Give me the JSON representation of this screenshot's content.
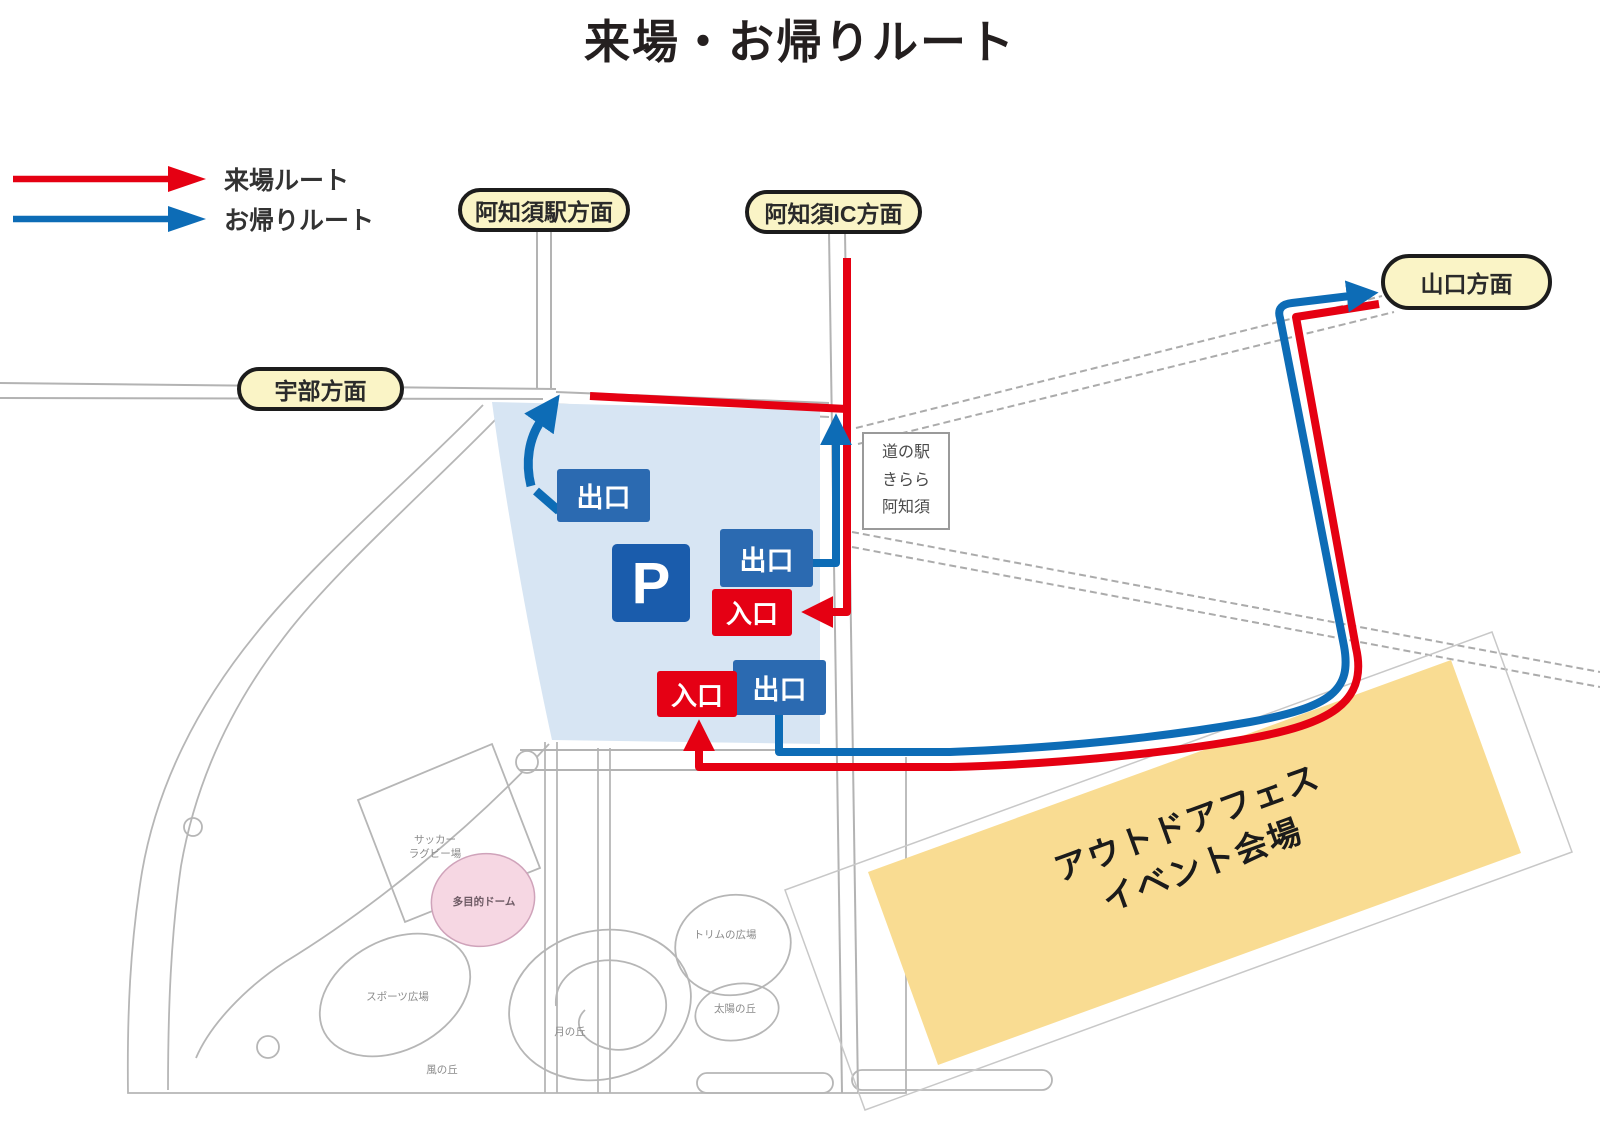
{
  "title": "来場・お帰りルート",
  "legend": {
    "arrival": {
      "label": "来場ルート",
      "color": "#e50012"
    },
    "return": {
      "label": "お帰りルート",
      "color": "#0d6cb6"
    }
  },
  "directions": {
    "station": "阿知須駅方面",
    "ic": "阿知須IC方面",
    "yamaguchi": "山口方面",
    "ube": "宇部方面"
  },
  "parking": {
    "symbol": "P",
    "exit_label": "出口",
    "entrance_label": "入口",
    "area_color": "#d7e5f3"
  },
  "roadside_station": {
    "text": "道の駅\nきらら\n阿知須"
  },
  "venue": {
    "label": "アウトドアフェス\nイベント会場",
    "fill_color": "#f9dc92"
  },
  "map_labels": {
    "soccer_rugby": "サッカー\nラグビー場",
    "dome": "多目的ドーム",
    "sports_plaza": "スポーツ広場",
    "trim_plaza": "トリムの広場",
    "moon_hill": "月の丘",
    "sun_hill": "太陽の丘",
    "wind_hill": "風の丘"
  },
  "colors": {
    "route_arrival": "#e50012",
    "route_return": "#0d6cb6",
    "pill_bg": "#faf4c6",
    "exit_box": "#2b6ab1",
    "entrance_box": "#e50014",
    "parking_fill": "#d7e5f3",
    "venue_fill": "#f9dc92",
    "dome_fill": "#f6d7e3"
  }
}
